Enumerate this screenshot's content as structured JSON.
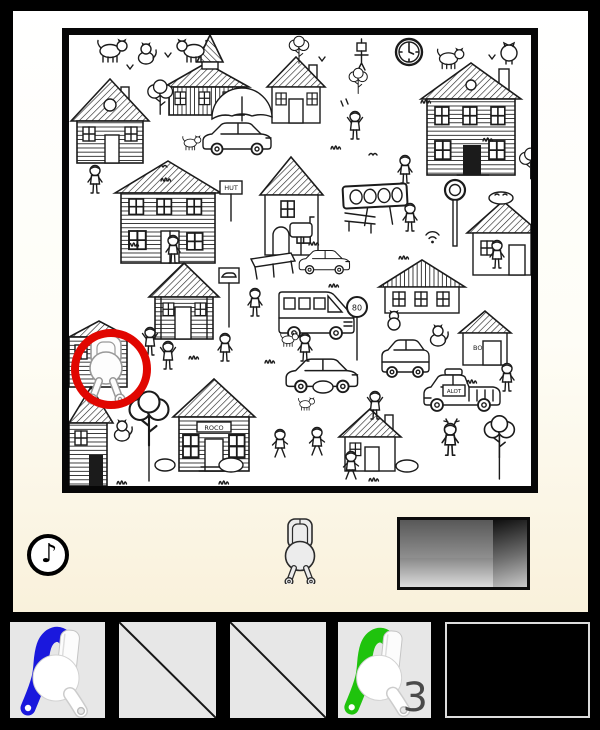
{
  "scene": {
    "description": "black-and-white hidden-object town illustration",
    "found_circle_color": "#e10600",
    "signs": {
      "storefront": "ROCO",
      "post": "HUT",
      "round": "80",
      "plate": "ALOT",
      "shed": "BO"
    }
  },
  "hint_bar": {
    "music_glyph": "♪"
  },
  "inventory": {
    "slots": [
      {
        "name": "figure-tool-blue",
        "state": "filled",
        "accent": "#1a18dd",
        "count": ""
      },
      {
        "name": "empty-slot",
        "state": "empty",
        "accent": "",
        "count": ""
      },
      {
        "name": "empty-slot",
        "state": "empty",
        "accent": "",
        "count": ""
      },
      {
        "name": "figure-tool-green",
        "state": "filled",
        "accent": "#1fc30d",
        "count": "3"
      },
      {
        "name": "display-slot",
        "state": "blank",
        "accent": "",
        "count": ""
      }
    ]
  },
  "colors": {
    "background": "#000000",
    "panel_top": "#ffffff",
    "panel_bottom": "#f8f1dc",
    "slot_bg": "#e7e7e7",
    "count_color": "#4a4a4a"
  }
}
